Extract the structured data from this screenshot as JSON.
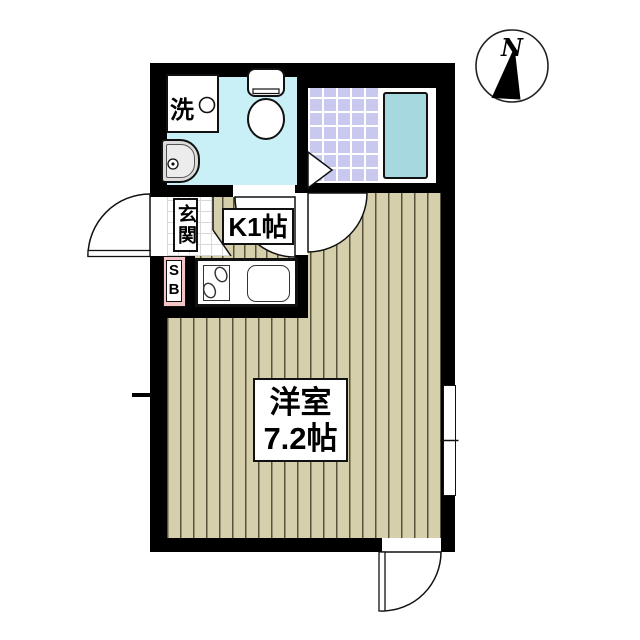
{
  "page": {
    "type": "japanese-apartment-floor-plan"
  },
  "compass": {
    "label": "N"
  },
  "labels": {
    "washer": "洗",
    "entrance": "玄関",
    "kitchen": "K1帖",
    "shoebox_s": "S",
    "shoebox_b": "B",
    "main_room_name": "洋室",
    "main_room_size": "7.2帖"
  },
  "colors": {
    "wall": "#000000",
    "washroom_floor": "#c9eff7",
    "bath_tile": "#c9c9ef",
    "bathtub": "#a5d9df",
    "wood_floor": "#d5cfab",
    "floor_stripe": "#56523d",
    "shoebox": "#f3c5c7"
  }
}
